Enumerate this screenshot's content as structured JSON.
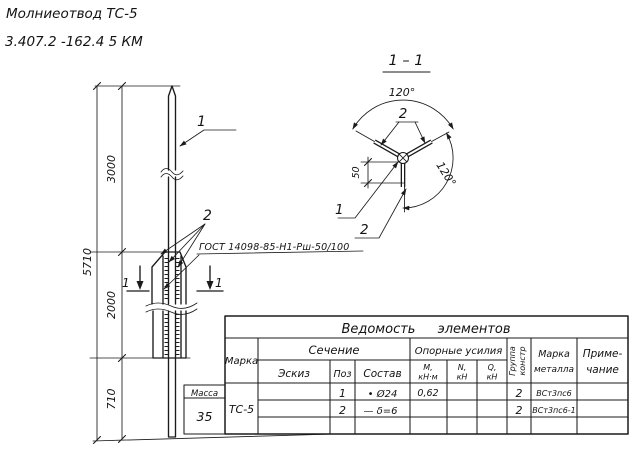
{
  "header": {
    "line1": "Молниеотвод ТС-5",
    "line2": "3.407.2 -162.4  5 КМ"
  },
  "main_view": {
    "dim_overall": "5710",
    "dim_top": "3000",
    "dim_mid": "2000",
    "dim_bottom": "710",
    "pos_rod": "1",
    "pos_plates": "2",
    "section_mark_left": "1",
    "section_mark_right": "1",
    "gost_note": "ГОСТ 14098-85-Н1-Рш-50/100"
  },
  "section_view": {
    "title": "1 – 1",
    "angle_top": "120°",
    "angle_side": "120°",
    "dim_offset": "50",
    "pos_rod": "1",
    "pos_plates_top": "2",
    "pos_plate_bottom": "2"
  },
  "table": {
    "title": "Ведомость элементов",
    "headers": {
      "marka": "Марка",
      "sechenie": "Сечение",
      "eskiz": "Эскиз",
      "poz": "Поз",
      "sostav": "Состав",
      "forces": "Опорные усилия",
      "m1": "М,",
      "m2": "кН·м",
      "n1": "N,",
      "n2": "кН",
      "q1": "Q,",
      "q2": "кН",
      "group1": "Группа",
      "group2": "констр",
      "metal1": "Марка",
      "metal2": "металла",
      "note1": "Приме-",
      "note2": "чание",
      "massa": "Масса"
    },
    "massa_value": "35",
    "marka_value": "ТС-5",
    "rows": [
      {
        "poz": "1",
        "sostav": "• Ø24",
        "m": "0,62",
        "n": "",
        "q": "",
        "group": "2",
        "metal": "ВСт3пс6",
        "note": ""
      },
      {
        "poz": "2",
        "sostav": "— δ=6",
        "m": "",
        "n": "",
        "q": "",
        "group": "2",
        "metal": "ВСт3пс6-1",
        "note": ""
      },
      {
        "poz": "",
        "sostav": "",
        "m": "",
        "n": "",
        "q": "",
        "group": "",
        "metal": "",
        "note": ""
      }
    ]
  }
}
